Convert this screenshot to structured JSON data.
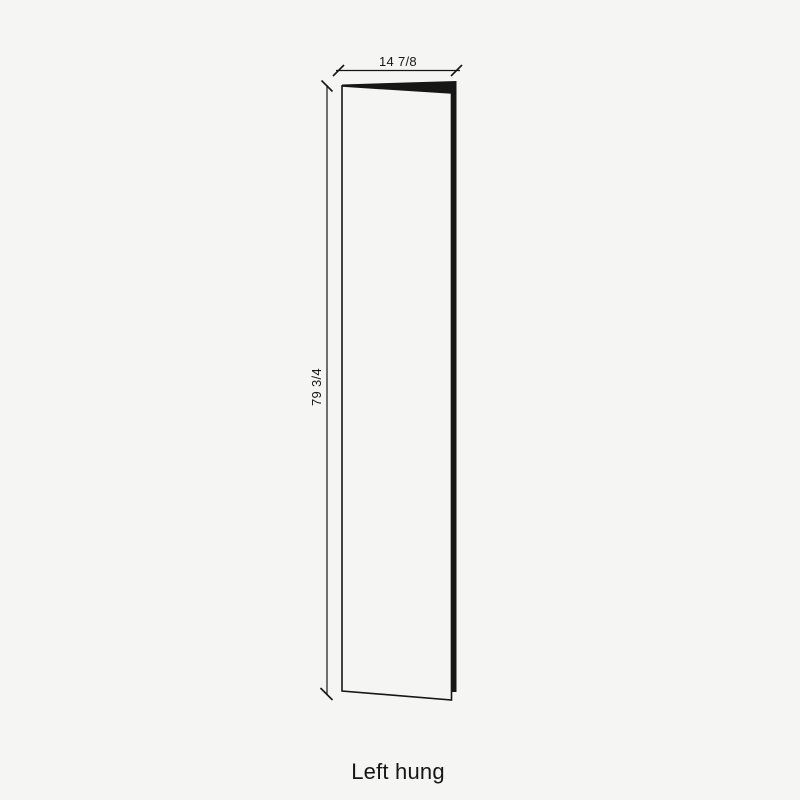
{
  "diagram": {
    "type": "door-panel-dimension-drawing",
    "width_label": "14 7/8",
    "height_label": "79 3/4",
    "caption": "Left hung",
    "colors": {
      "background": "#f5f5f4",
      "line": "#161616"
    }
  }
}
